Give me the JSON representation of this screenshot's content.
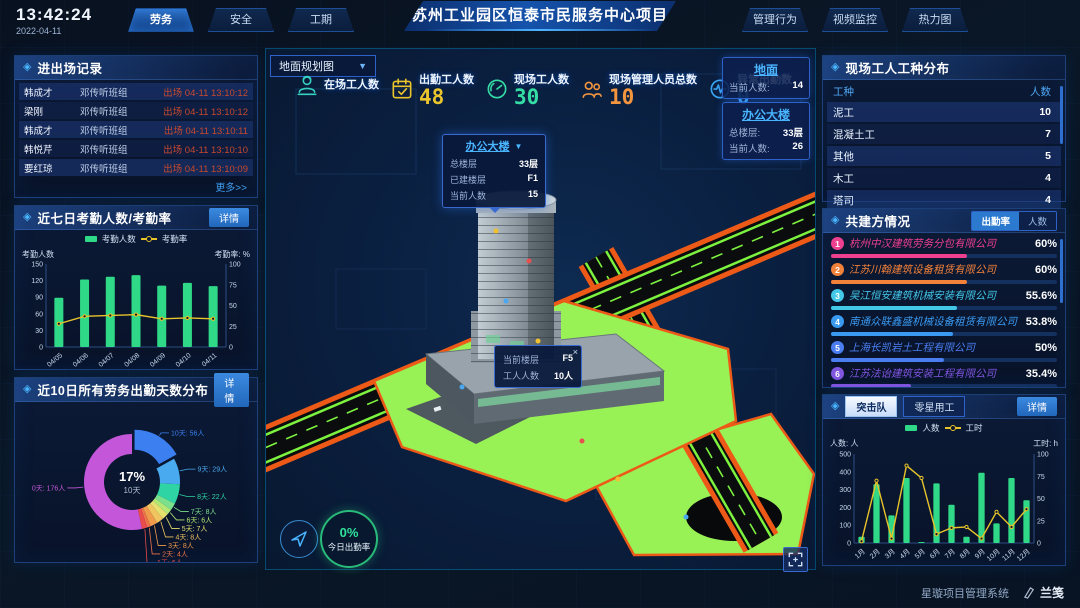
{
  "header": {
    "time": "13:42:24",
    "date": "2022-04-11",
    "title": "苏州工业园区恒泰市民服务中心项目",
    "left_tabs": [
      {
        "label": "劳务",
        "active": true
      },
      {
        "label": "安全",
        "active": false
      },
      {
        "label": "工期",
        "active": false
      }
    ],
    "right_tabs": [
      {
        "label": "管理行为"
      },
      {
        "label": "视频监控"
      },
      {
        "label": "热力图"
      }
    ]
  },
  "entry_panel": {
    "title": "进出场记录",
    "more": "更多>>",
    "rows": [
      {
        "name": "韩成才",
        "group": "邓传听班组",
        "event": "出场 04-11 13:10:12"
      },
      {
        "name": "梁刚",
        "group": "邓传听班组",
        "event": "出场 04-11 13:10:12"
      },
      {
        "name": "韩成才",
        "group": "邓传听班组",
        "event": "出场 04-11 13:10:11"
      },
      {
        "name": "韩悦芹",
        "group": "邓传听班组",
        "event": "出场 04-11 13:10:10"
      },
      {
        "name": "要红琼",
        "group": "邓传听班组",
        "event": "出场 04-11 13:10:09"
      }
    ]
  },
  "attendance_panel": {
    "title": "近七日考勤人数/考勤率",
    "detail": "详情"
  },
  "distribution_panel": {
    "title": "近10日所有劳务出勤天数分布",
    "detail": "详情"
  },
  "trade_panel": {
    "title": "现场工人工种分布",
    "columns": [
      "工种",
      "人数"
    ],
    "rows": [
      {
        "trade": "泥工",
        "count": "10"
      },
      {
        "trade": "混凝土工",
        "count": "7"
      },
      {
        "trade": "其他",
        "count": "5"
      },
      {
        "trade": "木工",
        "count": "4"
      },
      {
        "trade": "塔司",
        "count": "4"
      }
    ]
  },
  "company_panel": {
    "title": "共建方情况",
    "tabs": [
      {
        "label": "出勤率",
        "active": true
      },
      {
        "label": "人数",
        "active": false
      }
    ],
    "companies": [
      {
        "rank": "1",
        "name": "杭州中汉建筑劳务分包有限公司",
        "value": "60%",
        "pct": 60,
        "color": "#ef3f8f"
      },
      {
        "rank": "2",
        "name": "江苏川翰建筑设备租赁有限公司",
        "value": "60%",
        "pct": 60,
        "color": "#f2813a"
      },
      {
        "rank": "3",
        "name": "吴江恒安建筑机械安装有限公司",
        "value": "55.6%",
        "pct": 55.6,
        "color": "#43c8e8"
      },
      {
        "rank": "4",
        "name": "南通众联鑫盛机械设备租赁有限公司",
        "value": "53.8%",
        "pct": 53.8,
        "color": "#3a9af2"
      },
      {
        "rank": "5",
        "name": "上海长凯岩土工程有限公司",
        "value": "50%",
        "pct": 50,
        "color": "#4a7df0"
      },
      {
        "rank": "6",
        "name": "江苏法诒建筑安装工程有限公司",
        "value": "35.4%",
        "pct": 35.4,
        "color": "#8055e0"
      }
    ]
  },
  "assault_panel": {
    "tabs": [
      {
        "label": "突击队",
        "active": true
      },
      {
        "label": "零星用工",
        "active": false
      }
    ],
    "detail": "详情"
  },
  "map": {
    "selector": {
      "value": "地面规划图"
    },
    "stats": [
      {
        "icon": "worker-icon",
        "label": "在场工人数",
        "value": "",
        "color": "#35d0c0"
      },
      {
        "icon": "calendar-check-icon",
        "label": "出勤工人数",
        "value": "48",
        "color": "#e9c42d"
      },
      {
        "icon": "gauge-icon",
        "label": "现场工人数",
        "value": "30",
        "color": "#35dca4"
      },
      {
        "icon": "people-icon",
        "label": "现场管理人员总数",
        "value": "10",
        "color": "#f2953e"
      },
      {
        "icon": "pulse-icon",
        "label": "异常出勤数",
        "value": "0",
        "color": "#3aa6f2"
      }
    ],
    "location_boxes": [
      {
        "name": "地面",
        "rows": [
          {
            "label": "当前人数:",
            "value": "14"
          }
        ]
      },
      {
        "name": "办公大楼",
        "rows": [
          {
            "label": "总楼层:",
            "value": "33层"
          },
          {
            "label": "当前人数:",
            "value": "26"
          }
        ]
      }
    ],
    "building_tooltip": {
      "title": "办公大楼",
      "rows": [
        {
          "label": "总楼层",
          "value": "33层"
        },
        {
          "label": "已建楼层",
          "value": "F1"
        },
        {
          "label": "当前人数",
          "value": "15"
        }
      ]
    },
    "floor_tooltip": {
      "close": "×",
      "rows": [
        {
          "label": "当前楼层",
          "value": "F5"
        },
        {
          "label": "工人人数",
          "value": "10人"
        }
      ]
    },
    "today_rate": {
      "value": "0%",
      "label": "今日出勤率"
    }
  },
  "footer": {
    "system": "星璇项目管理系统",
    "logo": "兰笺"
  },
  "chart_data": [
    {
      "id": "attendance7",
      "type": "bar-line",
      "categories": [
        "04/05",
        "04/06",
        "04/07",
        "04/08",
        "04/09",
        "04/10",
        "04/11"
      ],
      "bar": {
        "name": "考勤人数",
        "values": [
          89,
          122,
          127,
          130,
          111,
          116,
          110
        ],
        "color": "#2fd987",
        "axis": {
          "label": "考勤人数",
          "min": 0,
          "max": 150,
          "step": 30
        }
      },
      "line": {
        "name": "考勤率",
        "values": [
          28,
          37,
          38,
          39,
          34,
          35,
          34
        ],
        "color": "#e8c32a",
        "axis": {
          "label": "考勤率: %",
          "min": 0,
          "max": 100,
          "step": 25
        }
      }
    },
    {
      "id": "workdays10",
      "type": "donut",
      "center": {
        "percent": "17%",
        "label": "10天"
      },
      "label_suffix": "人",
      "slices": [
        {
          "label": "10天",
          "value": 56,
          "color": "#3b7ff0",
          "exploded": true
        },
        {
          "label": "9天",
          "value": 29,
          "color": "#49aaf0"
        },
        {
          "label": "8天",
          "value": 22,
          "color": "#2fd4a4"
        },
        {
          "label": "7天",
          "value": 8,
          "color": "#7be08c"
        },
        {
          "label": "6天",
          "value": 6,
          "color": "#b4e874"
        },
        {
          "label": "5天",
          "value": 7,
          "color": "#e6e06e"
        },
        {
          "label": "4天",
          "value": 8,
          "color": "#f0c45e"
        },
        {
          "label": "3天",
          "value": 8,
          "color": "#f09a4c"
        },
        {
          "label": "2天",
          "value": 4,
          "color": "#ee7148"
        },
        {
          "label": "1天",
          "value": 6,
          "color": "#e84c4c"
        },
        {
          "label": "0天",
          "value": 176,
          "color": "#c457d9"
        }
      ]
    },
    {
      "id": "assault12",
      "type": "bar-line",
      "categories": [
        "1月",
        "2月",
        "3月",
        "4月",
        "5月",
        "6月",
        "7月",
        "8月",
        "9月",
        "10月",
        "11月",
        "12月"
      ],
      "bar": {
        "name": "人数",
        "values": [
          35,
          330,
          155,
          365,
          5,
          335,
          215,
          35,
          395,
          110,
          365,
          240
        ],
        "color": "#2fd987",
        "axis": {
          "label": "人数: 人",
          "min": 0,
          "max": 500,
          "step": 100
        }
      },
      "line": {
        "name": "工时",
        "values": [
          2,
          70,
          5,
          87,
          73,
          10,
          17,
          18,
          5,
          35,
          18,
          38
        ],
        "color": "#e8c32a",
        "axis": {
          "label": "工时: h",
          "min": 0,
          "max": 100,
          "step": 25
        }
      }
    }
  ]
}
